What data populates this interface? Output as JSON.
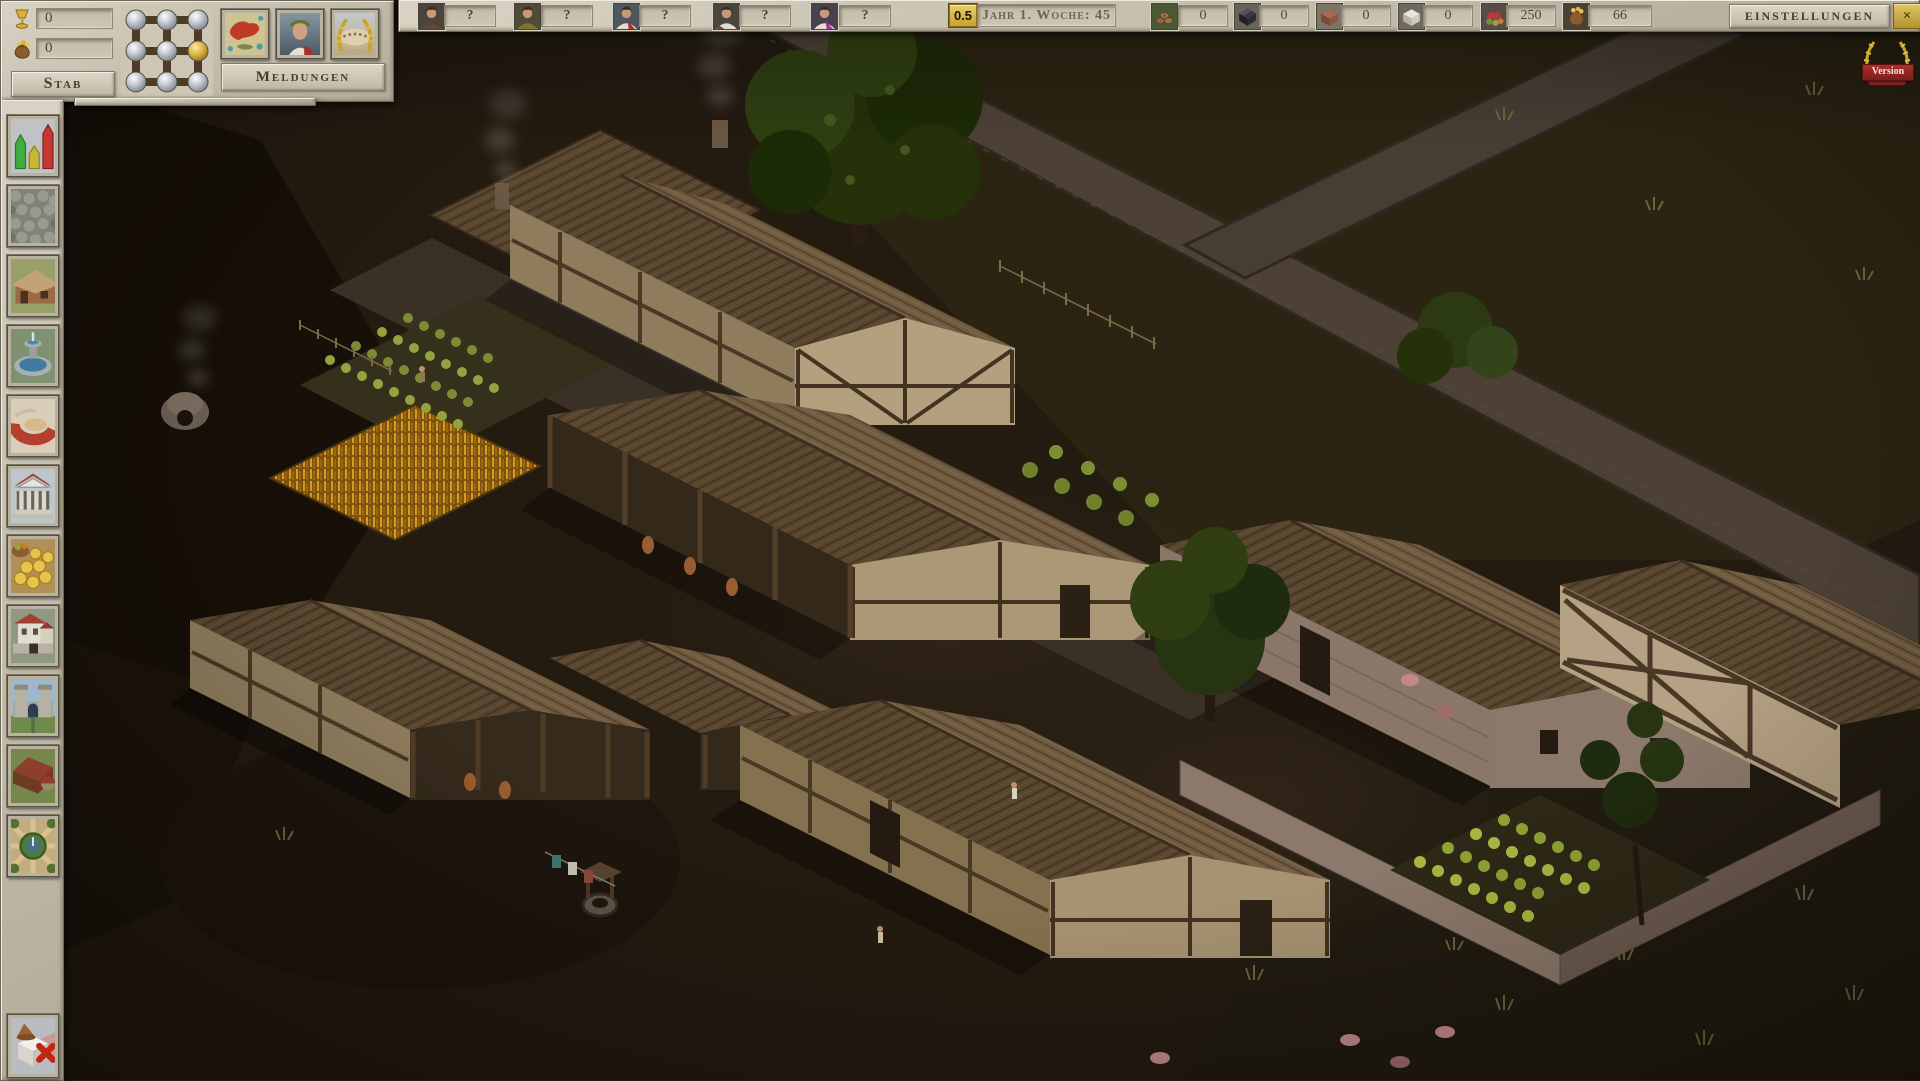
{
  "hud": {
    "staff_panel": {
      "label": "Stab",
      "rows": [
        {
          "icon": "goblet-icon",
          "value": "0"
        },
        {
          "icon": "moneybag-icon",
          "value": "0"
        }
      ]
    },
    "mill_board": {
      "icon": "mill-game-board",
      "silver_studs": 8,
      "gold_studs": 1
    },
    "messages_panel": {
      "label": "Meldungen",
      "icons": [
        "empire-map-icon",
        "emperor-portrait-icon",
        "arena-wreath-icon"
      ]
    },
    "advisors": [
      {
        "value": "?"
      },
      {
        "value": "?"
      },
      {
        "value": "?"
      },
      {
        "value": "?"
      },
      {
        "value": "?"
      }
    ],
    "speed": {
      "value": "0.5"
    },
    "date": {
      "value": "Jahr 1. Woche: 45"
    },
    "resources": [
      {
        "name": "wood",
        "icon": "wood-icon",
        "value": "0"
      },
      {
        "name": "coal",
        "icon": "coal-icon",
        "value": "0"
      },
      {
        "name": "brick",
        "icon": "brick-icon",
        "value": "0"
      },
      {
        "name": "marble",
        "icon": "marble-icon",
        "value": "0"
      },
      {
        "name": "food",
        "icon": "food-icon",
        "value": "250"
      },
      {
        "name": "gold",
        "icon": "gold-icon",
        "value": "66"
      }
    ],
    "settings_button": {
      "label": "Einstellungen"
    },
    "close_button": {
      "label": "×"
    },
    "version_badge": {
      "label": "Version"
    }
  },
  "sidebar": {
    "items": [
      {
        "name": "statistics"
      },
      {
        "name": "roads"
      },
      {
        "name": "housing"
      },
      {
        "name": "fountain"
      },
      {
        "name": "arena"
      },
      {
        "name": "temple"
      },
      {
        "name": "market"
      },
      {
        "name": "estate"
      },
      {
        "name": "city-gate"
      },
      {
        "name": "farm"
      },
      {
        "name": "garden"
      },
      {
        "name": "demolish"
      }
    ]
  },
  "colors": {
    "accent_gold": "#d6b44a",
    "panel_stone": "#c9c2b0",
    "text_dark": "#4b4534",
    "ground_dark": "#241b10"
  }
}
